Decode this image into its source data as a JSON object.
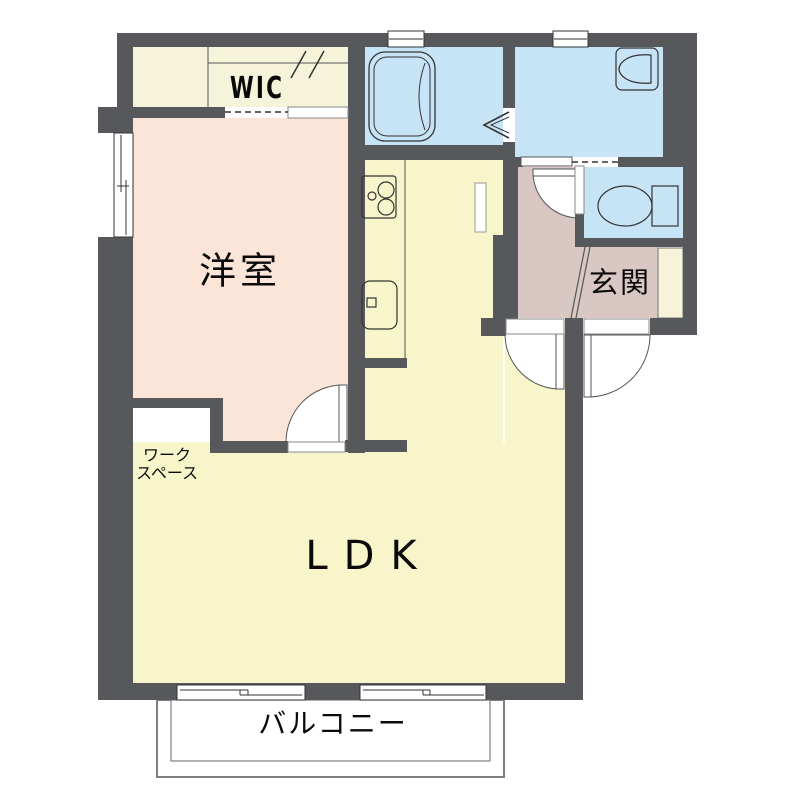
{
  "type": "floor-plan",
  "rooms": {
    "wic": {
      "label": "WIC"
    },
    "bedroom": {
      "label": "洋室"
    },
    "ldk": {
      "label": "LDK"
    },
    "entry": {
      "label": "玄関"
    },
    "balcony": {
      "label": "バルコニー"
    },
    "workspace": {
      "label_line1": "ワーク",
      "label_line2": "スペース"
    }
  },
  "fixtures": {
    "bathtub": "bathtub-icon",
    "washbasin": "washbasin-icon",
    "toilet": "toilet-icon",
    "stove": "stove-icon",
    "kitchen_sink": "kitchen-sink-icon",
    "closet_hanger": "hanger-pipe-icon",
    "entrance_step": "entrance-step-icon",
    "bath_folding_door": "folding-door-icon",
    "swing_doors": "door-swing-icon",
    "sliding_windows": "sliding-window-icon"
  },
  "colors": {
    "wall": "#56585c",
    "closet": "#f5f3da",
    "bedroom": "#fae5d8",
    "ldk": "#f8f5cb",
    "wet_area": "#c7e3f6",
    "entry": "#d8c7c3",
    "balcony_outline": "#7f7f7f",
    "line": "#333333"
  }
}
